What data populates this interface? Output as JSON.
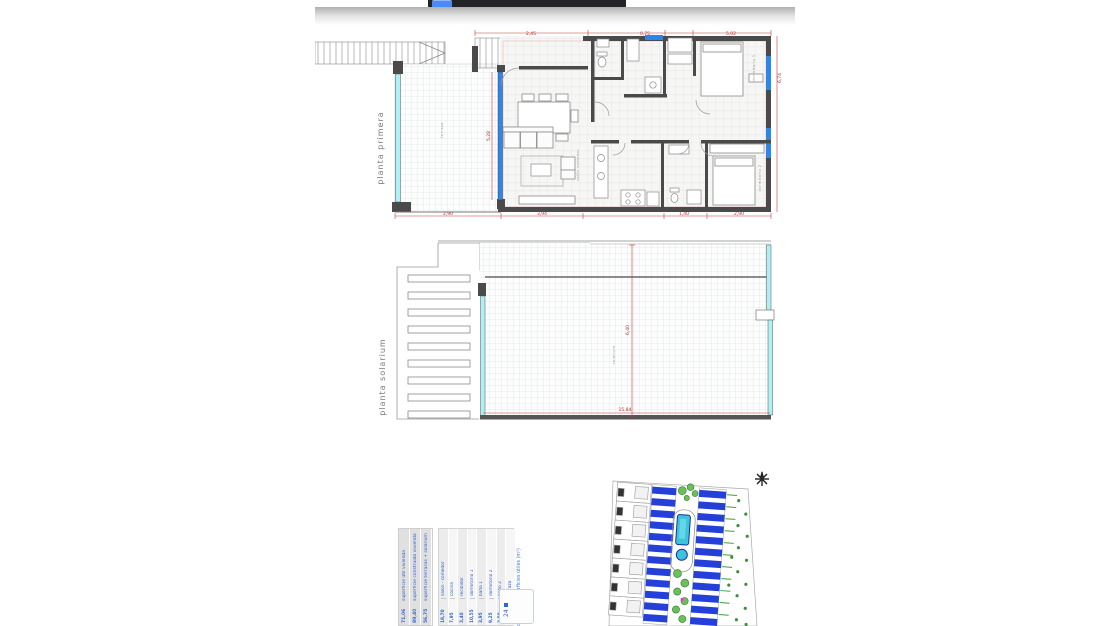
{
  "viewer": {
    "toolbar_color": "#232327",
    "button_color": "#4a8af4"
  },
  "floor_plans": {
    "first": {
      "name_label": "planta primera",
      "terrace_label": "terraza",
      "living_label": "salón comedor",
      "bedroom1_label": "dormitorio 1",
      "bedroom2_label": "dormitorio 2",
      "dim_top_porch": "2,45",
      "dim_top_mid": "0,75",
      "dim_top_right": "5,02",
      "dim_bottom_terrace": "2,90",
      "dim_bottom_living": "3,94",
      "dim_bottom_bath": "1,40",
      "dim_bottom_bedroom": "2,90",
      "dim_living_window": "5,28",
      "dim_right_side": "6,74"
    },
    "solarium": {
      "name_label": "planta solarium",
      "room_label": "solarium",
      "dim_vertical": "6,40",
      "dim_bottom": "15,84"
    }
  },
  "area_table": {
    "title": "cuadro de superficies útiles (m²)",
    "summary_rows": [
      {
        "label": "superficie útil vivienda",
        "value": "71,06"
      },
      {
        "label": "superficie construida vivienda",
        "value": "89,40"
      },
      {
        "label": "superficie terrazas + solarium",
        "value": "56,75"
      }
    ],
    "rows": [
      {
        "label": "salón - comedor",
        "value": "18,70"
      },
      {
        "label": "cocina",
        "value": "7,95"
      },
      {
        "label": "recibidor",
        "value": "3,40"
      },
      {
        "label": "dormitorio 1",
        "value": "10,55"
      },
      {
        "label": "baño 1",
        "value": "3,95"
      },
      {
        "label": "dormitorio 2",
        "value": "9,25"
      },
      {
        "label": "baño 2",
        "value": "3,50"
      },
      {
        "label": "terraza",
        "value": "9,60"
      }
    ],
    "unit_box_label": "24",
    "text_color": "#3565c8"
  },
  "site_plan": {
    "north_icon": "north-star-icon",
    "roof_color": "#2440d8",
    "pool_color": "#3cc4dc",
    "tree_color": "#4aa044"
  }
}
